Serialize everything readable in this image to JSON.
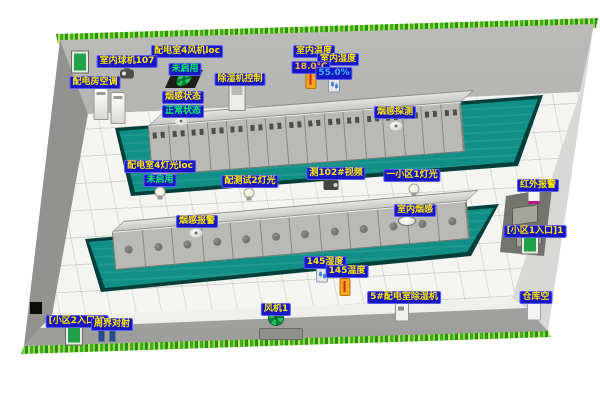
{
  "colors": {
    "label_bg": "#1717c3",
    "label_fg": "#ffe800",
    "status_green": "#00ff5a",
    "value_temp": "#ffb830",
    "value_hum": "#3db4ff",
    "mat_teal": "#0f8f85",
    "trim_green": "#3fae1f"
  },
  "cabinets": {
    "row1": 16,
    "row2": 12
  },
  "labels": [
    {
      "id": "power-room-fan-label",
      "text": "配电室4风机loc",
      "x": 187,
      "y": 45,
      "style": "blue"
    },
    {
      "id": "indoor-dome-camera-label",
      "text": "室内球机107",
      "x": 127,
      "y": 55,
      "style": "blue"
    },
    {
      "id": "power-room-fan-status",
      "text": "未启用",
      "x": 185,
      "y": 63,
      "style": "green"
    },
    {
      "id": "dehumidifier-control-label",
      "text": "除湿机控制",
      "x": 240,
      "y": 73,
      "style": "blue"
    },
    {
      "id": "power-room-ac-label",
      "text": "配电房空调",
      "x": 95,
      "y": 76,
      "style": "blue"
    },
    {
      "id": "indoor-temp-label",
      "text": "室内温度",
      "x": 314,
      "y": 45,
      "style": "blue"
    },
    {
      "id": "indoor-humidity-label",
      "text": "室内湿度",
      "x": 338,
      "y": 53,
      "style": "blue"
    },
    {
      "id": "indoor-temp-value",
      "text": "18.0℃",
      "x": 311,
      "y": 61,
      "style": "temp"
    },
    {
      "id": "indoor-humidity-value",
      "text": "55.0%",
      "x": 334,
      "y": 67,
      "style": "hum"
    },
    {
      "id": "smoke-status-label",
      "text": "烟感状态",
      "x": 183,
      "y": 91,
      "style": "blue"
    },
    {
      "id": "smoke-status-value",
      "text": "正常状态",
      "x": 183,
      "y": 105,
      "style": "green"
    },
    {
      "id": "smoke-detect-label",
      "text": "烟感探测",
      "x": 395,
      "y": 106,
      "style": "blue"
    },
    {
      "id": "power-room-light-label",
      "text": "配电室4灯光loc",
      "x": 160,
      "y": 160,
      "style": "blue"
    },
    {
      "id": "power-room-light-status",
      "text": "未启用",
      "x": 160,
      "y": 174,
      "style": "green"
    },
    {
      "id": "test-light2-label",
      "text": "配测试2灯光",
      "x": 250,
      "y": 175,
      "style": "blue"
    },
    {
      "id": "video102-label",
      "text": "测102#视频",
      "x": 336,
      "y": 167,
      "style": "blue"
    },
    {
      "id": "area1-light-label",
      "text": "一小区1灯光",
      "x": 412,
      "y": 169,
      "style": "blue"
    },
    {
      "id": "infrared-alarm-label",
      "text": "红外报警",
      "x": 538,
      "y": 179,
      "style": "blue"
    },
    {
      "id": "indoor-smoke-label",
      "text": "室内烟感",
      "x": 415,
      "y": 204,
      "style": "blue"
    },
    {
      "id": "smoke-alarm-label",
      "text": "烟感报警",
      "x": 197,
      "y": 215,
      "style": "blue"
    },
    {
      "id": "entrance1-label",
      "text": "[小区1入口]1",
      "x": 535,
      "y": 225,
      "style": "blue"
    },
    {
      "id": "sensor145-humidity-label",
      "text": "145湿度",
      "x": 325,
      "y": 256,
      "style": "blue"
    },
    {
      "id": "sensor145-temp-label",
      "text": "145温度",
      "x": 347,
      "y": 265,
      "style": "blue"
    },
    {
      "id": "fan1-label",
      "text": "风机1",
      "x": 276,
      "y": 303,
      "style": "blue"
    },
    {
      "id": "dehumidifier5-label",
      "text": "5#配电室除湿机",
      "x": 404,
      "y": 291,
      "style": "blue"
    },
    {
      "id": "warehouse-ac-label",
      "text": "仓库空",
      "x": 536,
      "y": 291,
      "style": "blue"
    },
    {
      "id": "entrance2-label",
      "text": "[小区2入口]2",
      "x": 77,
      "y": 315,
      "style": "blue"
    },
    {
      "id": "perimeter-beam-label",
      "text": "周界对射",
      "x": 112,
      "y": 318,
      "style": "blue"
    }
  ],
  "icons": [
    {
      "name": "dome-camera-icon",
      "type": "dome-camera",
      "x": 127,
      "y": 74
    },
    {
      "name": "exhaust-fan-icon",
      "type": "fan-dark",
      "x": 184,
      "y": 79
    },
    {
      "name": "ac-unit-icon",
      "type": "ac-unit",
      "x": 101,
      "y": 104
    },
    {
      "name": "ac-unit2-icon",
      "type": "ac-unit",
      "x": 118,
      "y": 108
    },
    {
      "name": "dehumidifier-control-icon",
      "type": "control-box",
      "x": 237,
      "y": 97
    },
    {
      "name": "indoor-thermometer-icon",
      "type": "thermometer",
      "x": 311,
      "y": 80
    },
    {
      "name": "indoor-humidity-icon",
      "type": "humidity",
      "x": 334,
      "y": 85
    },
    {
      "name": "smoke-status-detector-icon",
      "type": "smoke",
      "x": 181,
      "y": 121
    },
    {
      "name": "smoke-detect-detector-icon",
      "type": "smoke",
      "x": 396,
      "y": 126
    },
    {
      "name": "power-room-light-bulb-icon",
      "type": "bulb",
      "x": 160,
      "y": 192
    },
    {
      "name": "test-light2-bulb-icon",
      "type": "bulb",
      "x": 249,
      "y": 193
    },
    {
      "name": "video102-camera-icon",
      "type": "box-camera",
      "x": 331,
      "y": 185
    },
    {
      "name": "area1-light-bulb-icon",
      "type": "bulb",
      "x": 414,
      "y": 189
    },
    {
      "name": "indoor-smoke-detector-icon",
      "type": "smoke-dish",
      "x": 407,
      "y": 221
    },
    {
      "name": "smoke-alarm-detector-icon",
      "type": "smoke",
      "x": 196,
      "y": 233
    },
    {
      "name": "infrared-alarm-icon",
      "type": "infrared",
      "x": 534,
      "y": 196
    },
    {
      "name": "entrance1-door-icon",
      "type": "door-green",
      "x": 530,
      "y": 243
    },
    {
      "name": "sensor145-humidity-icon",
      "type": "humidity",
      "x": 322,
      "y": 275
    },
    {
      "name": "sensor145-thermometer-icon",
      "type": "thermometer",
      "x": 345,
      "y": 287
    },
    {
      "name": "fan1-icon",
      "type": "fan-wall",
      "x": 276,
      "y": 318
    },
    {
      "name": "fan1-vent",
      "type": "vent",
      "x": 281,
      "y": 334,
      "interactable": false
    },
    {
      "name": "dehumidifier5-icon",
      "type": "dehumidifier",
      "x": 402,
      "y": 312
    },
    {
      "name": "warehouse-ac-icon",
      "type": "ac-small",
      "x": 534,
      "y": 311
    },
    {
      "name": "entrance2-door-icon",
      "type": "door-green",
      "x": 74,
      "y": 334
    },
    {
      "name": "perimeter-beam-icon",
      "type": "beam-pair",
      "x": 107,
      "y": 336
    },
    {
      "name": "wall-junction-box",
      "type": "black-box",
      "x": 36,
      "y": 308,
      "interactable": false
    },
    {
      "name": "west-wall-door-icon",
      "type": "door-green",
      "x": 80,
      "y": 62
    }
  ]
}
